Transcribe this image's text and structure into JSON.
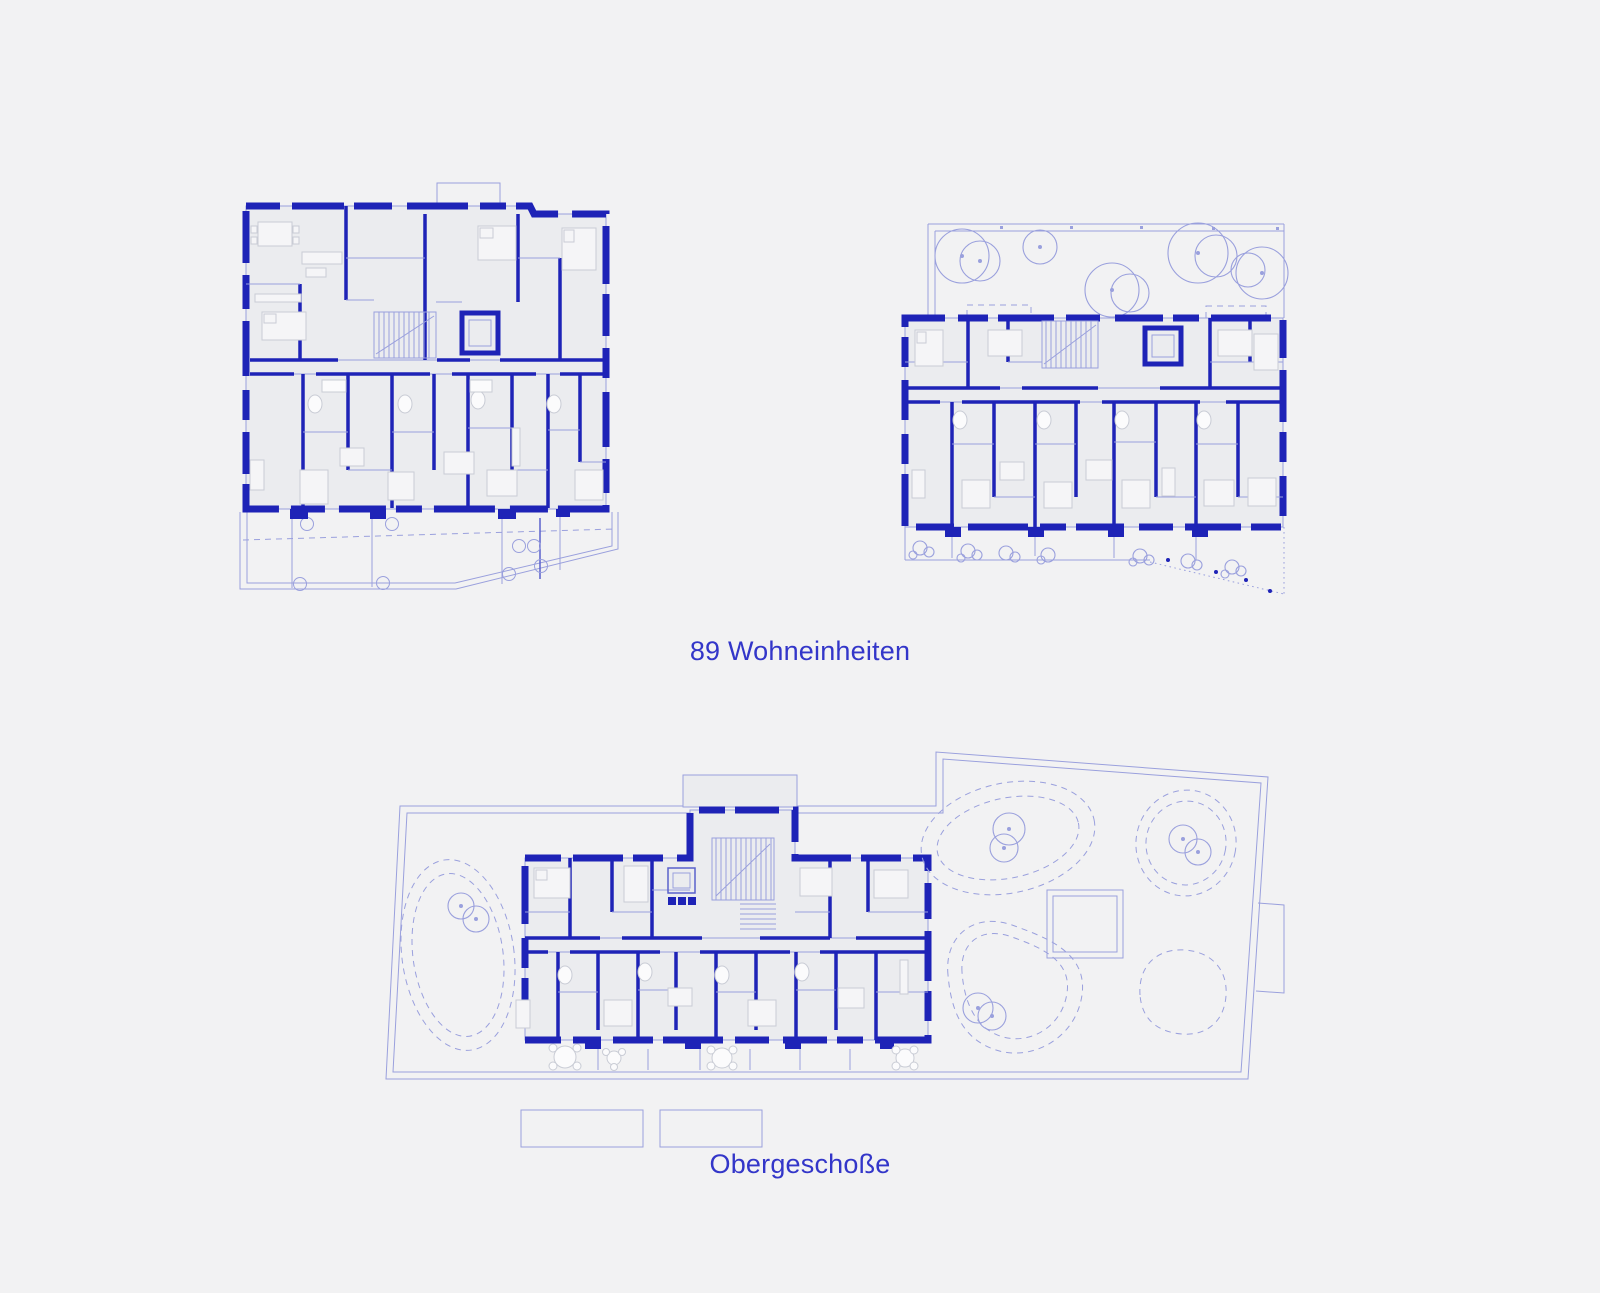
{
  "page": {
    "background": "#f2f2f3"
  },
  "colors": {
    "bg": "#f2f2f3",
    "wall": "#1e23b7",
    "mline": "#5a61cc",
    "line": "#9aa0dd",
    "text": "#3336c9",
    "room": "#ebecef",
    "furnfill": "#f5f5f7",
    "furnline": "#c9ccd5"
  },
  "labels": {
    "units_label": "89 Wohneinheiten",
    "floor_label": "Obergeschoße"
  }
}
